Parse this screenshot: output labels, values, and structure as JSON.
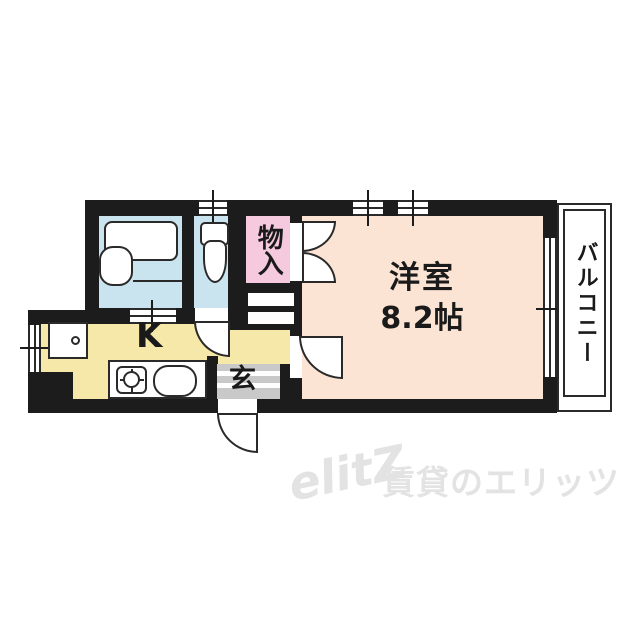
{
  "plan": {
    "rooms": {
      "main": {
        "label": "洋室",
        "size": "8.2帖"
      },
      "kitchen": {
        "label": "K"
      },
      "genkan": {
        "label": "玄"
      },
      "closet": {
        "label": "物入"
      }
    },
    "balcony": {
      "label": "バルコニー"
    }
  },
  "watermark": {
    "logo": "elitZ",
    "text": "賃貸のエリッツ"
  },
  "colors": {
    "wall": "#1c1c1c",
    "outline": "#2a2a2a",
    "water": "#c9e4ee",
    "closet": "#f5c9de",
    "main": "#fce4d4",
    "kitchen": "#f6e8a8",
    "genkan": "#c9c9c9",
    "text": "#1a1a1a",
    "watermark": "#e3e3e3"
  }
}
